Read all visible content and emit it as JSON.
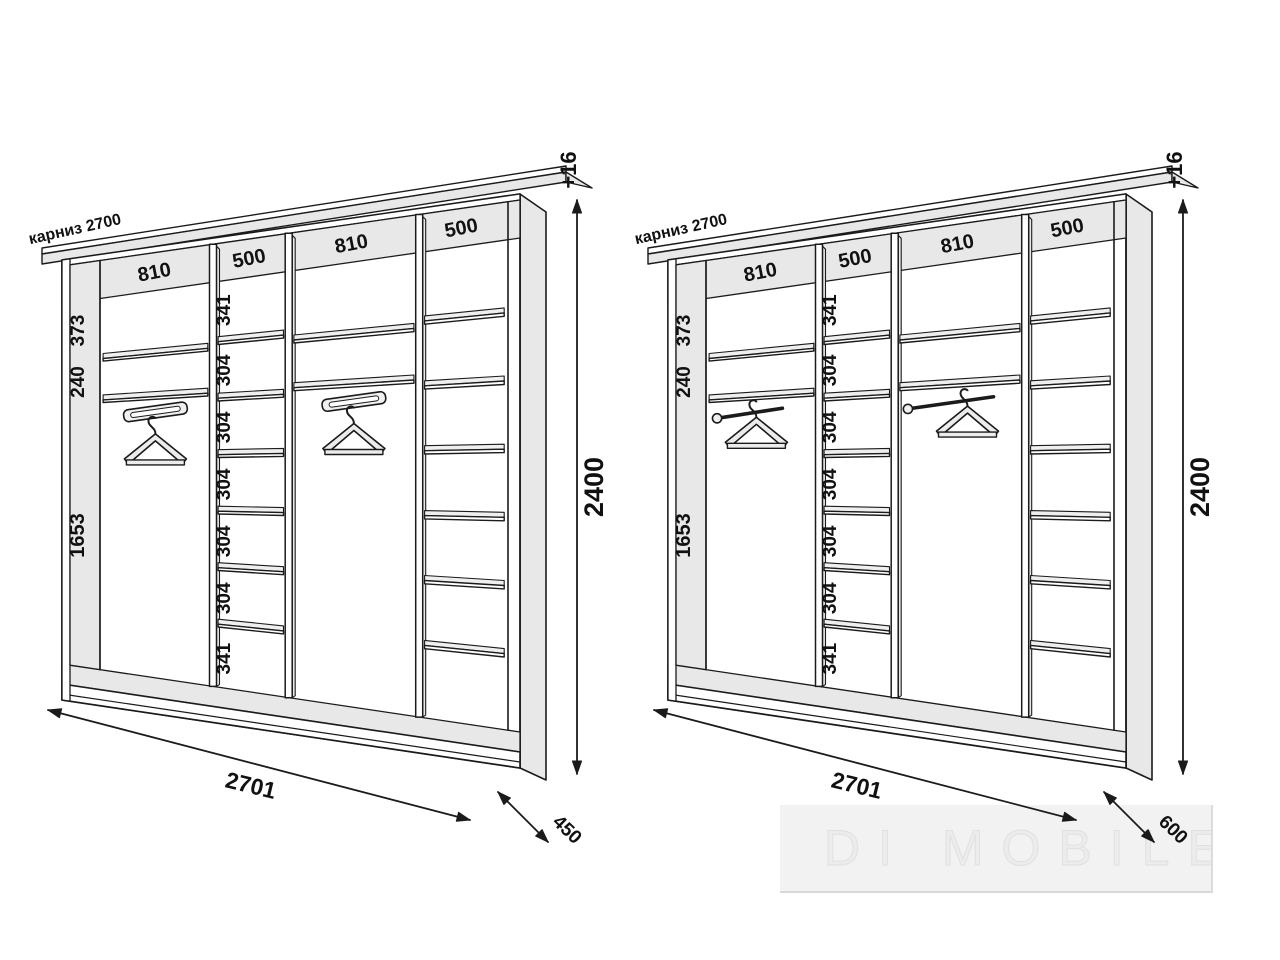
{
  "watermark": {
    "brand": "DI MOBILE",
    "logo": "house-sofa-icon"
  },
  "colors": {
    "line": "#1b1b1b",
    "panel": "#e8e8e8",
    "sliver": "#efefef",
    "text": "#111111",
    "white": "#ffffff"
  },
  "wardrobes": [
    {
      "id": "depth-450",
      "cornice_label": "карниз 2700",
      "top_section_labels": [
        "810",
        "500",
        "810",
        "500"
      ],
      "left_panel_labels": [
        "373",
        "240",
        "1653"
      ],
      "shelf_column_labels": [
        "341",
        "304",
        "304",
        "304",
        "304",
        "304",
        "341"
      ],
      "width_label": "2701",
      "height_label": "2400",
      "height_extra_label": "+16",
      "depth_label": "450",
      "hanger_style": "rail",
      "sections": [
        {
          "width_mm": 810,
          "type": "hanging",
          "top_shelf_heights_mm": [
            373,
            240
          ],
          "hanging_height_mm": 1653
        },
        {
          "width_mm": 500,
          "type": "shelves",
          "compartment_heights_mm": [
            341,
            304,
            304,
            304,
            304,
            304,
            341
          ],
          "labeled": true
        },
        {
          "width_mm": 810,
          "type": "hanging",
          "top_shelf_heights_mm": [
            373,
            240
          ],
          "hanging_height_mm": 1653
        },
        {
          "width_mm": 500,
          "type": "shelves",
          "compartment_heights_mm": [
            341,
            304,
            304,
            304,
            304,
            304,
            341
          ],
          "labeled": false
        }
      ]
    },
    {
      "id": "depth-600",
      "cornice_label": "карниз 2700",
      "top_section_labels": [
        "810",
        "500",
        "810",
        "500"
      ],
      "left_panel_labels": [
        "373",
        "240",
        "1653"
      ],
      "shelf_column_labels": [
        "341",
        "304",
        "304",
        "304",
        "304",
        "304",
        "341"
      ],
      "width_label": "2701",
      "height_label": "2400",
      "height_extra_label": "+16",
      "depth_label": "600",
      "hanger_style": "rod",
      "sections": [
        {
          "width_mm": 810,
          "type": "hanging",
          "top_shelf_heights_mm": [
            373,
            240
          ],
          "hanging_height_mm": 1653
        },
        {
          "width_mm": 500,
          "type": "shelves",
          "compartment_heights_mm": [
            341,
            304,
            304,
            304,
            304,
            304,
            341
          ],
          "labeled": true
        },
        {
          "width_mm": 810,
          "type": "hanging",
          "top_shelf_heights_mm": [
            373,
            240
          ],
          "hanging_height_mm": 1653
        },
        {
          "width_mm": 500,
          "type": "shelves",
          "compartment_heights_mm": [
            341,
            304,
            304,
            304,
            304,
            304,
            341
          ],
          "labeled": false
        }
      ]
    }
  ]
}
